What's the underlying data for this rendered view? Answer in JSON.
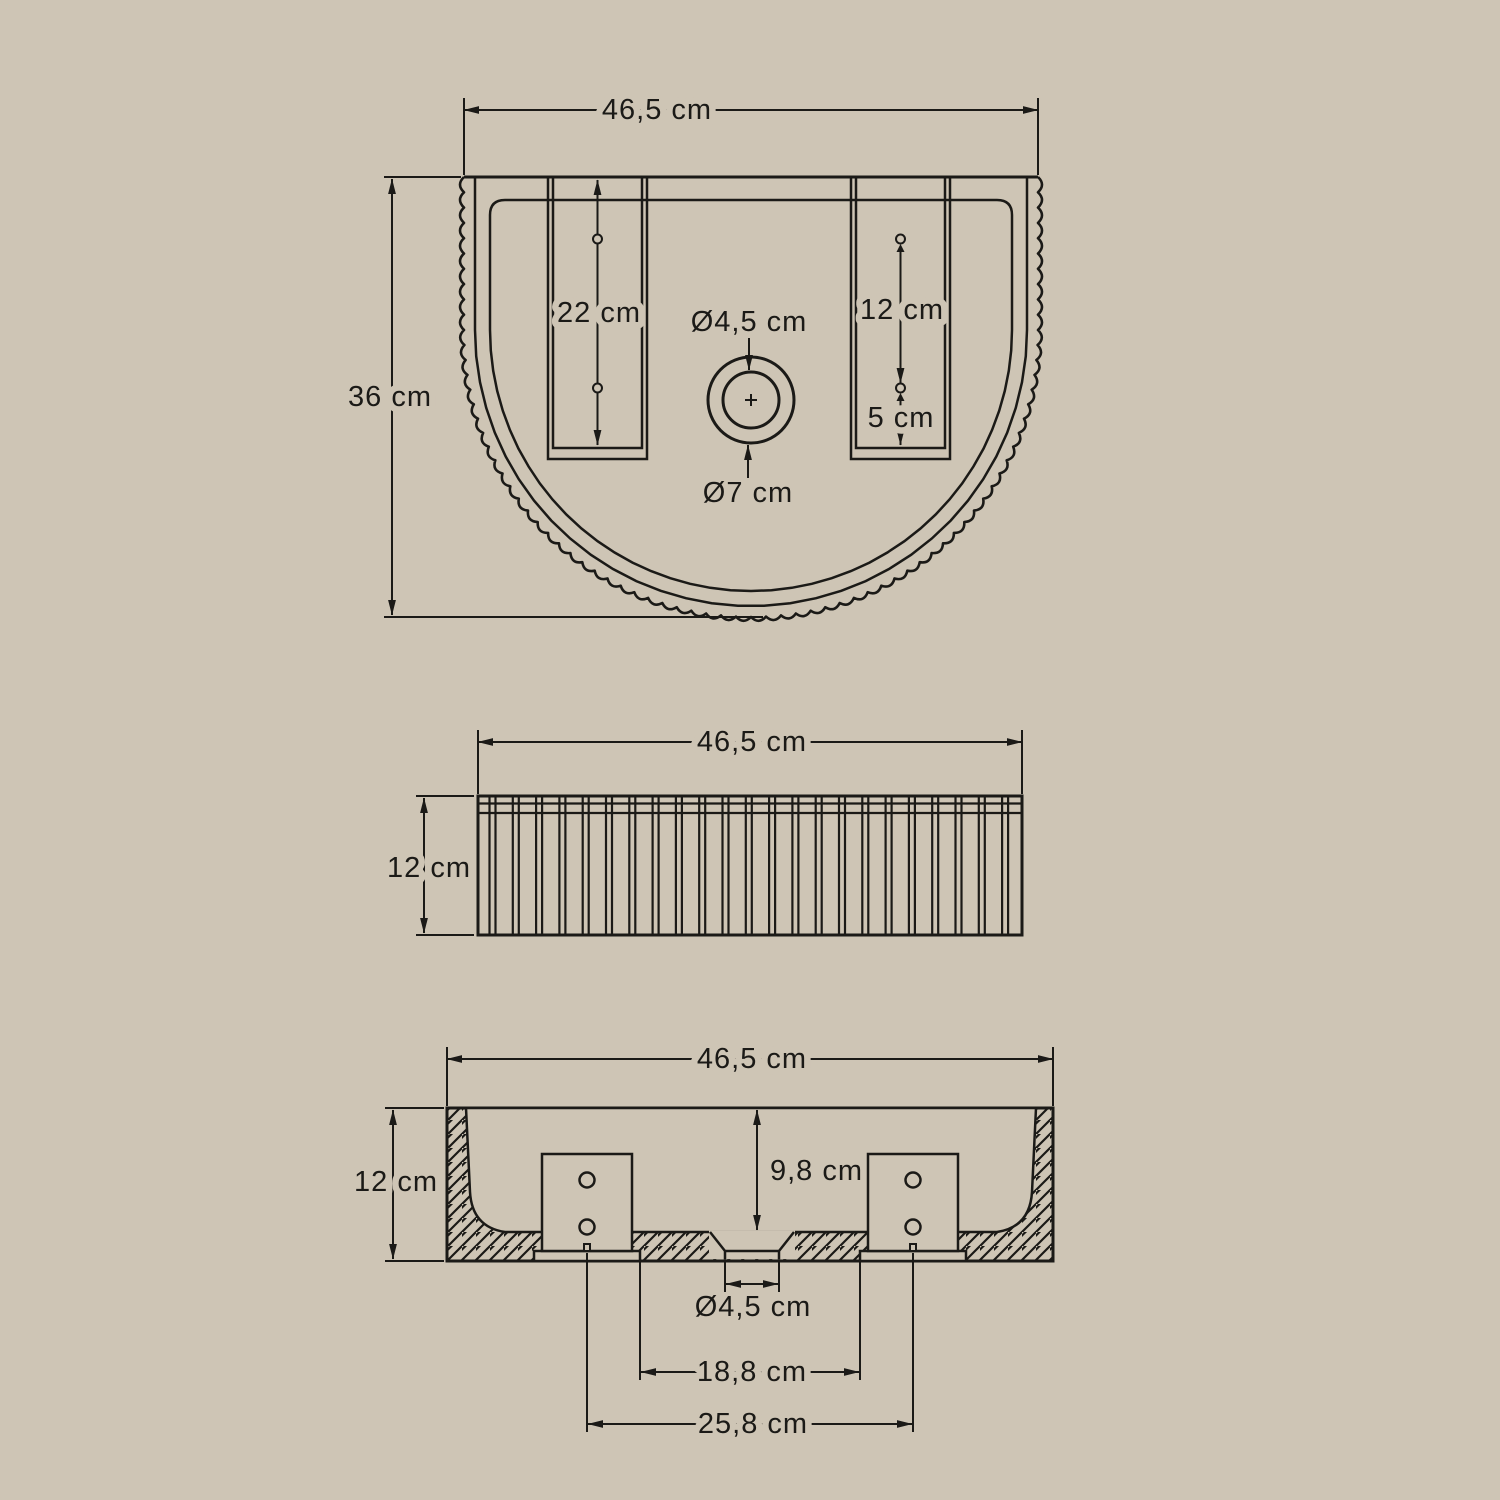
{
  "drawing": {
    "top_view": {
      "width": "46,5 cm",
      "height": "36 cm",
      "slot_depth": "22 cm",
      "slot_hole_spacing": "12 cm",
      "slot_hole_bottom_offset": "5 cm",
      "drain_inner_diameter": "Ø4,5 cm",
      "drain_outer_diameter": "Ø7 cm"
    },
    "front_view": {
      "width": "46,5 cm",
      "height": "12 cm"
    },
    "section_view": {
      "width": "46,5 cm",
      "height": "12 cm",
      "inner_depth": "9,8 cm",
      "drain_diameter": "Ø4,5 cm",
      "mounting_holes_inner_spacing": "18,8 cm",
      "mounting_holes_center_spacing": "25,8 cm"
    }
  },
  "colors": {
    "background": "#cec5b5",
    "ink": "#1b1a17"
  }
}
